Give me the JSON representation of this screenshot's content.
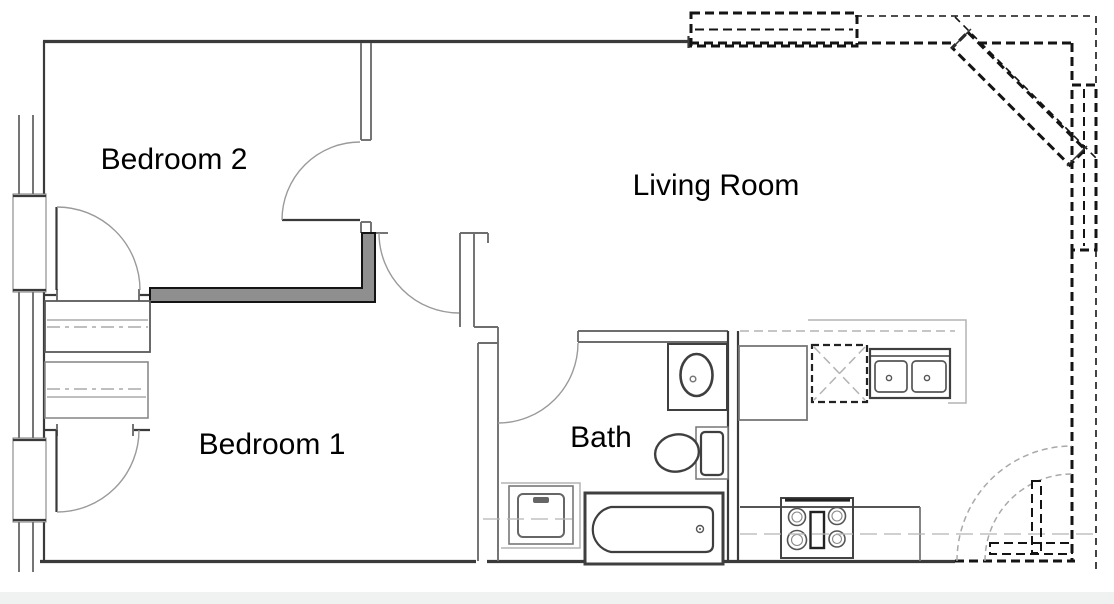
{
  "plan": {
    "title": "Apartment floor plan",
    "rooms": [
      {
        "id": "bedroom2",
        "label": "Bedroom 2"
      },
      {
        "id": "living_room",
        "label": "Living Room"
      },
      {
        "id": "bedroom1",
        "label": "Bedroom 1"
      },
      {
        "id": "bath",
        "label": "Bath"
      }
    ],
    "fixtures": [
      "window",
      "door-swing",
      "closet-shelf-and-rod",
      "new-partition-wall",
      "bathroom-sink",
      "toilet",
      "bathtub",
      "washer",
      "refrigerator",
      "dishwasher",
      "double-kitchen-sink",
      "range-stove",
      "dashed-existing-wall",
      "dashed-window",
      "dashed-door-swing"
    ],
    "colors": {
      "background": "#ffffff",
      "wall_dark": "#3a3a3a",
      "wall_medium": "#6e6e6e",
      "wall_light": "#b3b3b3",
      "new_wall_fill": "#8f8f8f",
      "dashed_wall": "#141414",
      "centerline": "#b5b5b5",
      "fixture_dark": "#3f3f3f",
      "fixture_medium": "#777777",
      "text": "#000000",
      "footer_bar": "#f0f1f1"
    }
  }
}
